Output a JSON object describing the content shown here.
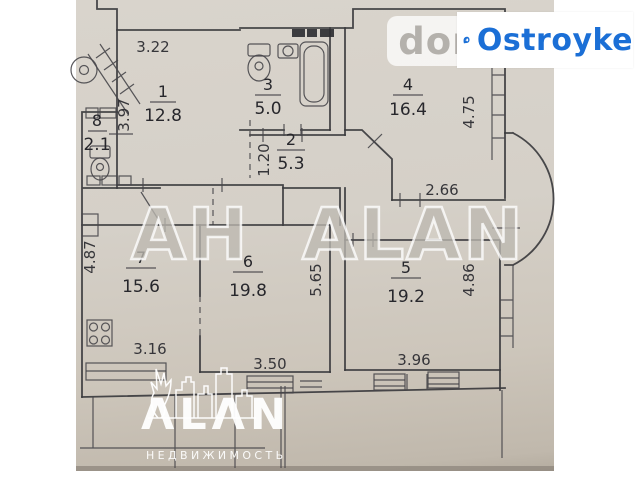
{
  "watermarks": {
    "center": "АН ALAN",
    "dom": "dom",
    "ostroyke": "Ostroyke",
    "alan_logo": "ΛLΛN",
    "alan_sub": "НЕДВИЖИМОСТЬ"
  },
  "colors": {
    "ostroyke_blue": "#1b6fd6",
    "paper": "#d5d0c8",
    "line": "#3b3b3e"
  },
  "plan": {
    "rooms": [
      {
        "number": "1",
        "area": "12.8"
      },
      {
        "number": "2",
        "area": "5.3"
      },
      {
        "number": "3",
        "area": "5.0"
      },
      {
        "number": "4",
        "area": "16.4"
      },
      {
        "number": "5",
        "area": "19.2"
      },
      {
        "number": "6",
        "area": "19.8"
      },
      {
        "number": "7",
        "area": "15.6"
      },
      {
        "number": "8",
        "area": "2.1"
      }
    ],
    "dimensions": {
      "d322": "3.22",
      "d397": "3.97",
      "d475": "4.75",
      "d120": "1.20",
      "d266": "2.66",
      "d487": "4.87",
      "d565": "5.65",
      "d486": "4.86",
      "d316": "3.16",
      "d350": "3.50",
      "d396": "3.96"
    }
  }
}
